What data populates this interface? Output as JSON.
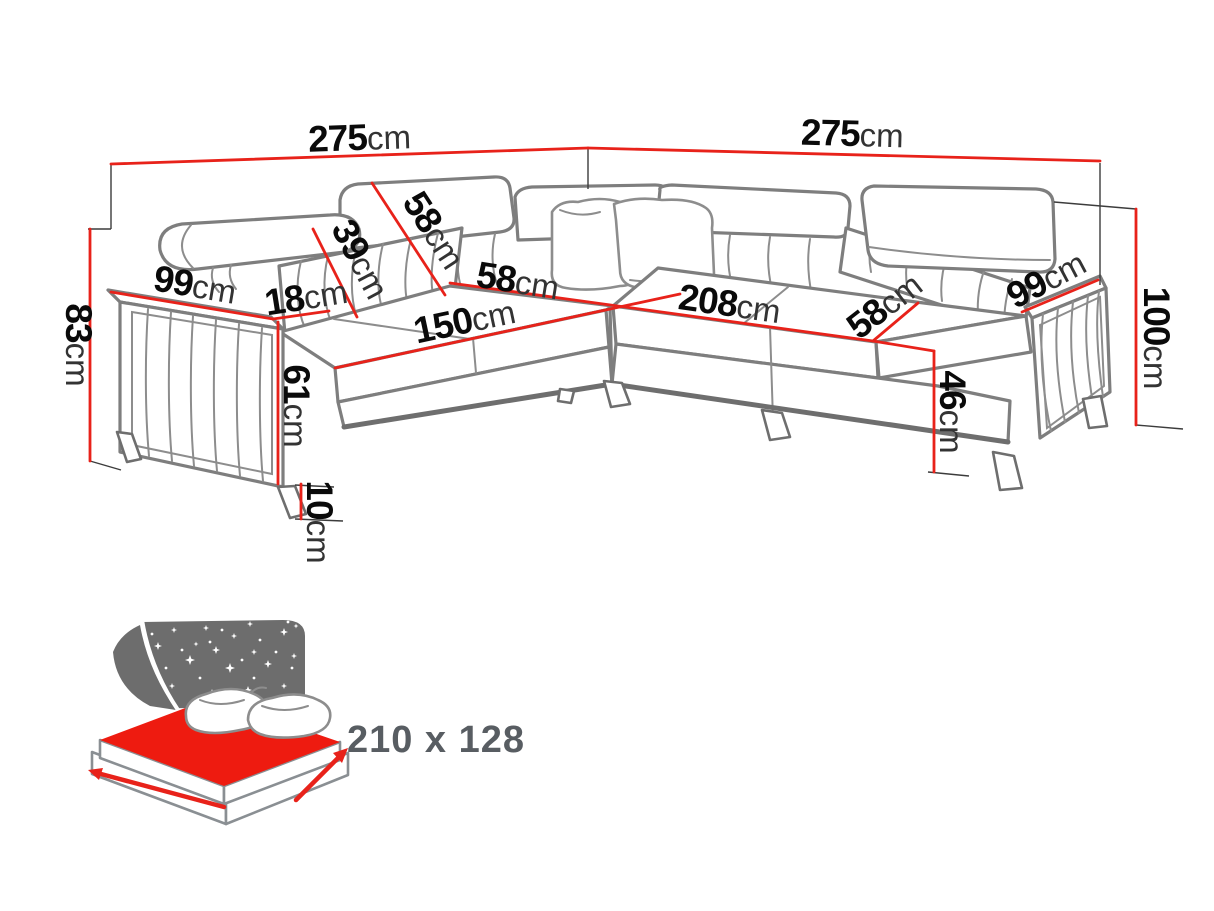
{
  "colors": {
    "background": "#ffffff",
    "sofa_outline": "#7e7e7e",
    "dimension_red": "#e8221a",
    "number_black": "#0a0a0a",
    "unit_gray": "#333333",
    "bed_backdrop_gray": "#6d6d6d",
    "bed_mattress_red": "#ee1b10",
    "bed_label_gray": "#585d62"
  },
  "dimensions": [
    {
      "id": "total-width-left",
      "number": "275",
      "unit": "cm"
    },
    {
      "id": "total-width-right",
      "number": "275",
      "unit": "cm"
    },
    {
      "id": "height-left",
      "number": "83",
      "unit": "cm"
    },
    {
      "id": "arm-depth-left",
      "number": "99",
      "unit": "cm"
    },
    {
      "id": "arm-width",
      "number": "18",
      "unit": "cm"
    },
    {
      "id": "seat-height-left",
      "number": "61",
      "unit": "cm"
    },
    {
      "id": "leg-height",
      "number": "10",
      "unit": "cm"
    },
    {
      "id": "backrest-low-height",
      "number": "39",
      "unit": "cm"
    },
    {
      "id": "backrest-high-height",
      "number": "58",
      "unit": "cm"
    },
    {
      "id": "seat-width-left",
      "number": "150",
      "unit": "cm"
    },
    {
      "id": "seat-depth-left",
      "number": "58",
      "unit": "cm"
    },
    {
      "id": "seat-width-right",
      "number": "208",
      "unit": "cm"
    },
    {
      "id": "seat-depth-right",
      "number": "58",
      "unit": "cm"
    },
    {
      "id": "seat-height-right",
      "number": "46",
      "unit": "cm"
    },
    {
      "id": "arm-depth-right",
      "number": "99",
      "unit": "cm"
    },
    {
      "id": "height-right",
      "number": "100",
      "unit": "cm"
    }
  ],
  "bed": {
    "icon": "bed-sleeping-area-icon",
    "size_label": "210 x 128"
  }
}
